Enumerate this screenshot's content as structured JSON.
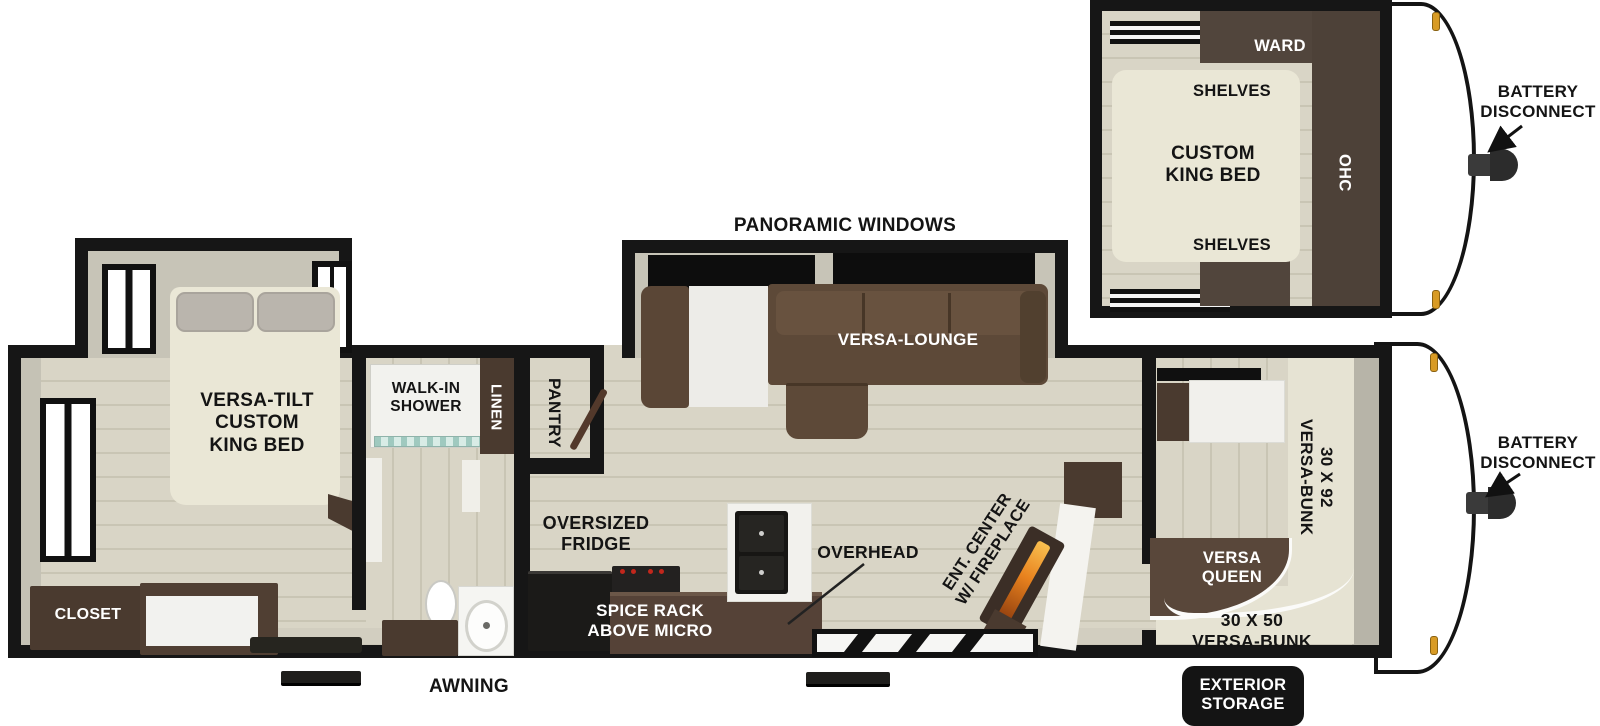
{
  "page": {
    "description": "Travel trailer RV floor plan diagram with bunk-room inset"
  },
  "colors": {
    "wall": "#161616",
    "floor": "#d9d5c6",
    "floor_line": "#c9c5b4",
    "wall_face": "#c6c3b6",
    "bed_cream": "#eae7d6",
    "cabinet_dark": "#4a3a2f",
    "counter_brown": "#554237",
    "sofa_brown": "#5d4938",
    "fixture_white": "#f4f3ef",
    "fireplace_flame": "#e8821e",
    "clearance_light": "#d89b25",
    "label_black": "#141414",
    "label_white": "#ffffff"
  },
  "inset": {
    "ward_label": "WARD",
    "shelves_top_label": "SHELVES",
    "bed_line1": "CUSTOM",
    "bed_line2": "KING BED",
    "ohc_label": "OHC",
    "shelves_bottom_label": "SHELVES",
    "battery_line1": "BATTERY",
    "battery_line2": "DISCONNECT"
  },
  "main": {
    "panoramic_windows_label": "PANORAMIC WINDOWS",
    "versa_lounge_label": "VERSA-LOUNGE",
    "bed_line1": "VERSA-TILT",
    "bed_line2": "CUSTOM",
    "bed_line3": "KING BED",
    "closet_label": "CLOSET",
    "shower_line1": "WALK-IN",
    "shower_line2": "SHOWER",
    "linen_label": "LINEN",
    "pantry_label": "PANTRY",
    "fridge_line1": "OVERSIZED",
    "fridge_line2": "FRIDGE",
    "overhead_label": "OVERHEAD",
    "spice_line1": "SPICE RACK",
    "spice_line2": "ABOVE MICRO",
    "ent_line1": "ENT. CENTER",
    "ent_line2": "W/ FIREPLACE",
    "bunk92_line1": "30 X 92",
    "bunk92_line2": "VERSA-BUNK",
    "queen_line1": "VERSA",
    "queen_line2": "QUEEN",
    "bunk50_line1": "30 X 50",
    "bunk50_line2": "VERSA-BUNK",
    "awning_label": "AWNING",
    "battery_line1": "BATTERY",
    "battery_line2": "DISCONNECT",
    "storage_line1": "EXTERIOR",
    "storage_line2": "STORAGE"
  }
}
